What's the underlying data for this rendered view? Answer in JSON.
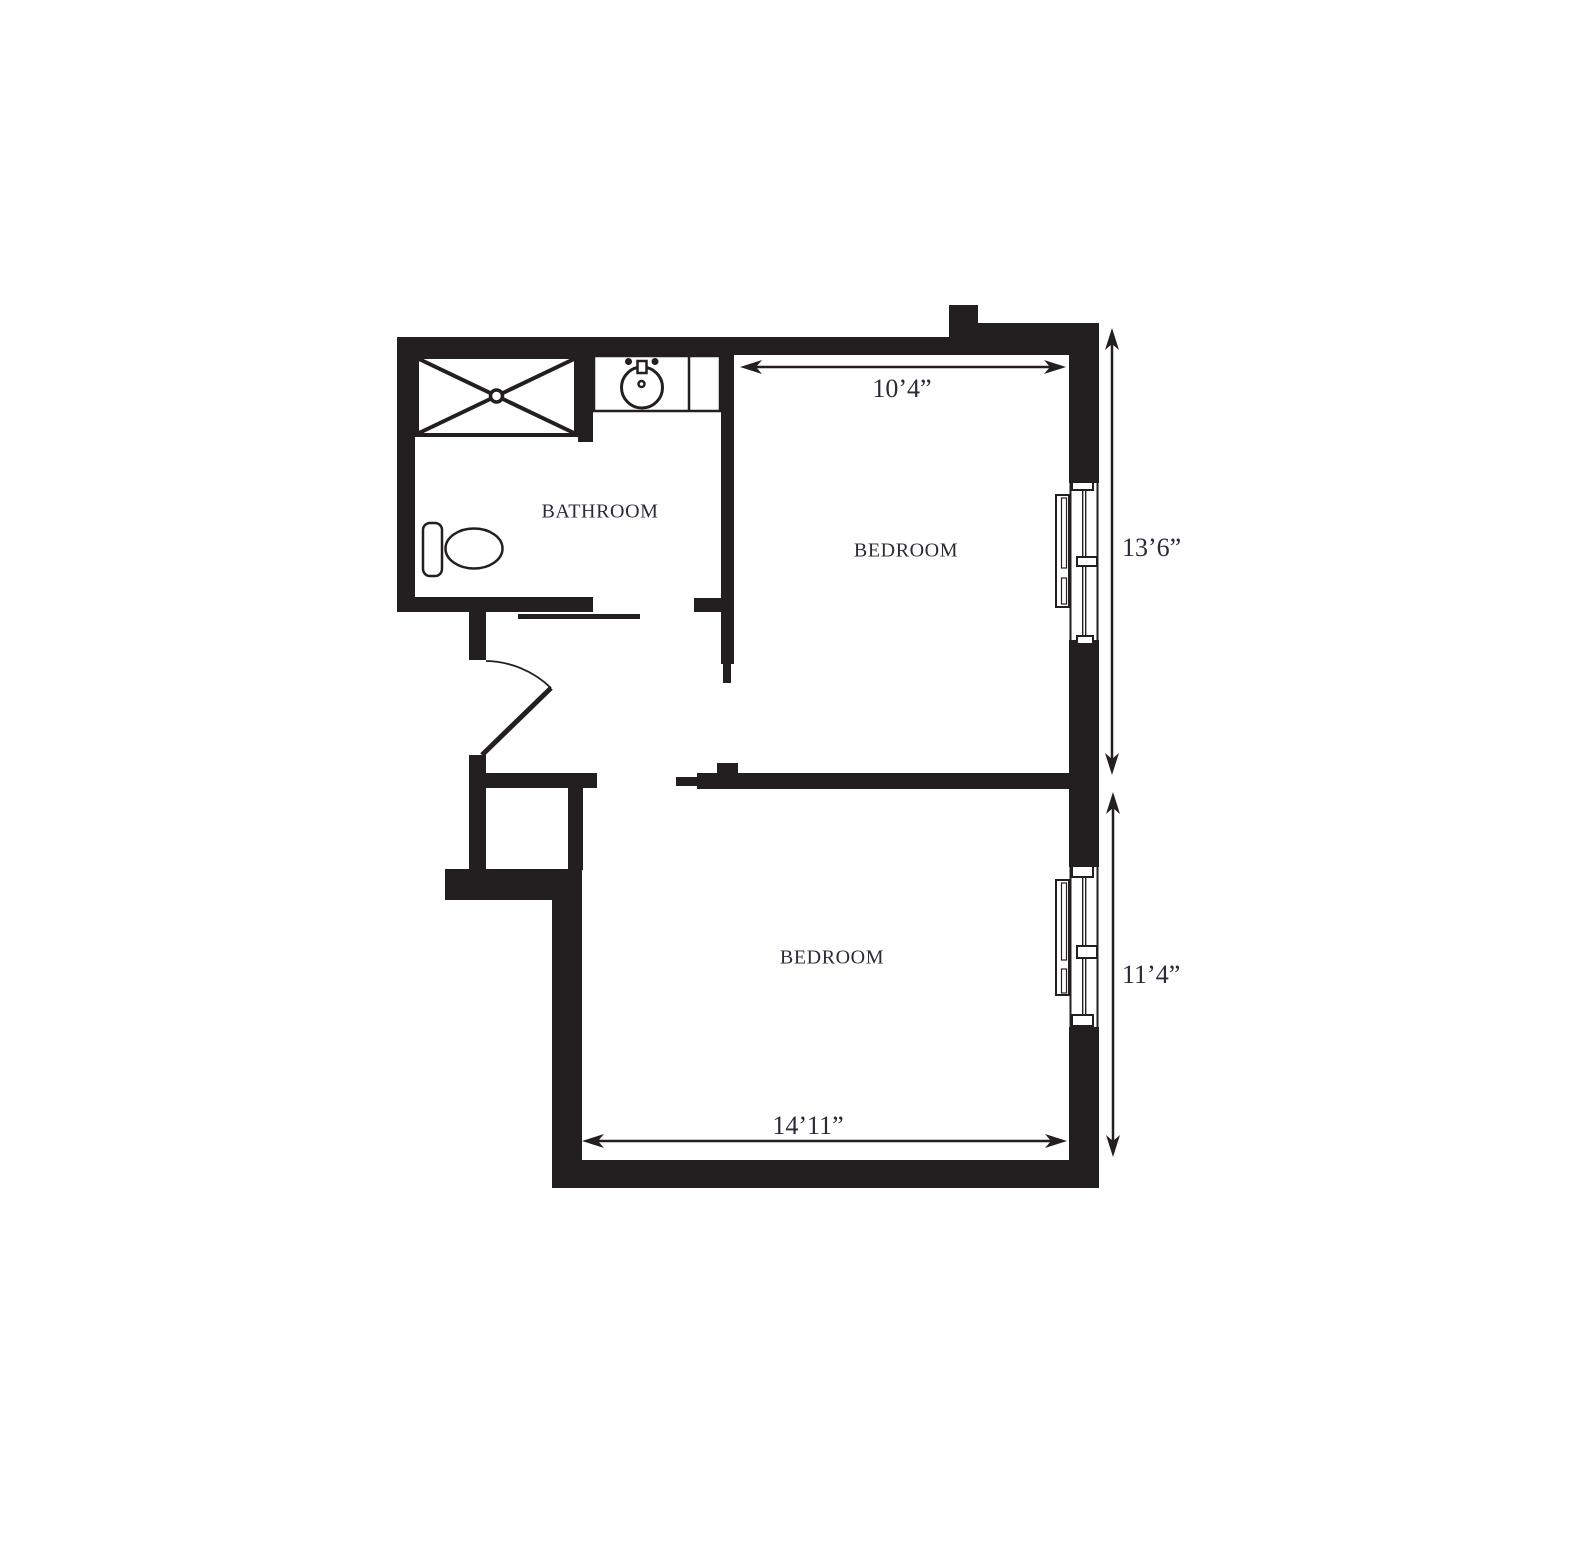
{
  "plan": {
    "rooms": {
      "bathroom": {
        "label": "BATHROOM"
      },
      "bedroom_top": {
        "label": "BEDROOM"
      },
      "bedroom_bottom": {
        "label": "BEDROOM"
      }
    },
    "dimensions": {
      "bedroom_top_width": "10’4”",
      "bedroom_top_depth": "13’6”",
      "bedroom_bottom_depth": "11’4”",
      "bedroom_bottom_width": "14’11”"
    },
    "fixtures": [
      "shower-icon",
      "sink-icon",
      "toilet-icon",
      "swing-door-icon",
      "pocket-door-icon",
      "window-icon",
      "window-icon"
    ],
    "colors": {
      "wall": "#231f20",
      "text": "#2d2a38",
      "background": "#ffffff"
    }
  }
}
